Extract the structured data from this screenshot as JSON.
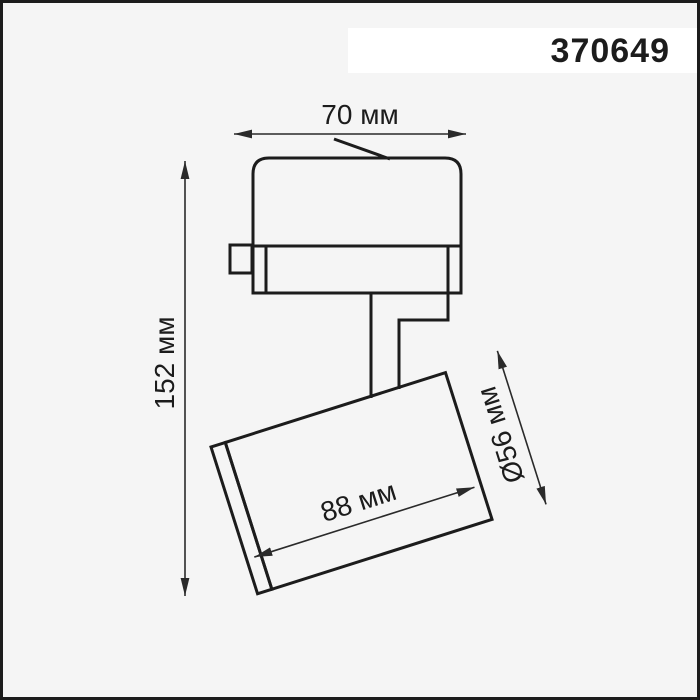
{
  "product": {
    "code": "370649"
  },
  "drawing": {
    "dim_width": "70 мм",
    "dim_height": "152 мм",
    "dim_body_length": "88 мм",
    "dim_diameter": "Ø56 мм"
  },
  "colors": {
    "background": "#f5f5f5",
    "line": "#1c1c1c",
    "dim_line": "#2a2a2a",
    "label_background": "#ffffff"
  }
}
